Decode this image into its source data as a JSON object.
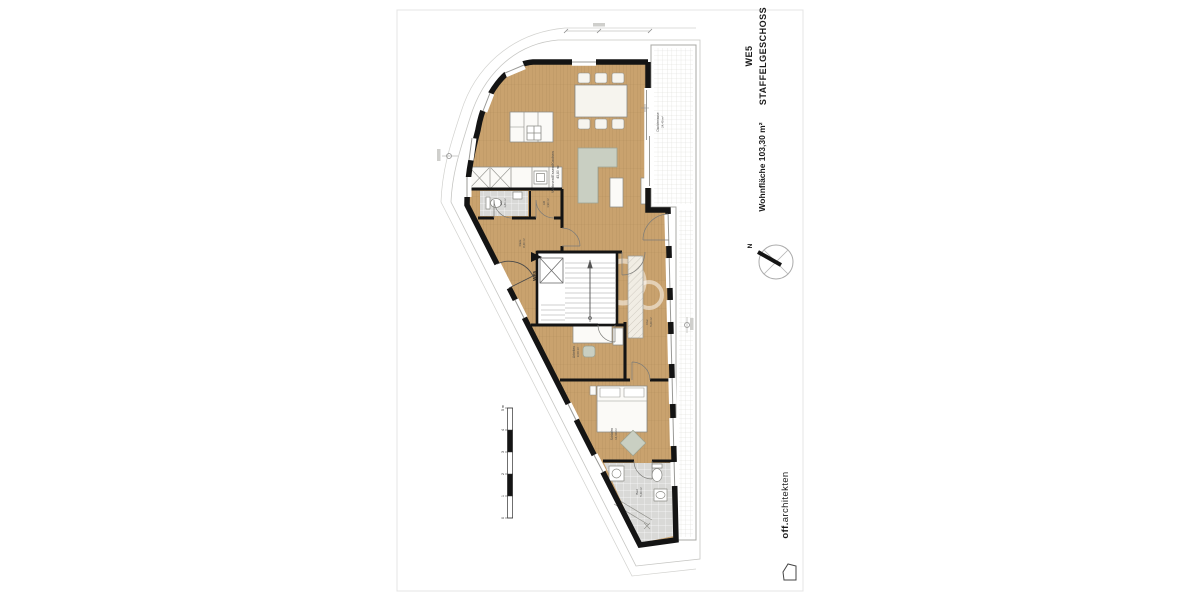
{
  "title_block": {
    "unit": "WE5",
    "floor": "STAFFELGESCHOSS",
    "area_label": "Wohnfläche 103,30 m²"
  },
  "compass": {
    "north_label": "N"
  },
  "logo": {
    "brand_bold": "off.",
    "brand_rest": "architekten"
  },
  "entrance_marker": {
    "label": "WE5"
  },
  "scale_bar": {
    "tick_labels": [
      "0",
      "1",
      "2",
      "3",
      "4",
      "5 m"
    ]
  },
  "rooms": {
    "living": {
      "name": "Wohnen/Essen/Kochen",
      "area": "43,80 m²"
    },
    "terrace": {
      "name": "Dachterrasse",
      "area": "24,40 m²"
    },
    "wc": {
      "name": "WC",
      "area": "1,80 m²"
    },
    "storage": {
      "name": "AR",
      "area": "1,90 m²"
    },
    "hall": {
      "name": "Diele",
      "area": "8,40 m²"
    },
    "corridor": {
      "name": "Flur",
      "area": "5,60 m²"
    },
    "office": {
      "name": "Arbeiten",
      "area": "9,60 m²"
    },
    "bedroom": {
      "name": "Schlafen",
      "area": "14,60 m²"
    },
    "bath": {
      "name": "Bad",
      "area": "5,40 m²"
    }
  },
  "icons": {
    "compass_needle": "north-arrow-icon",
    "logo_mark": "house-icon",
    "entrance_arrow": "entrance-arrow-icon"
  },
  "colors": {
    "wall": "#141414",
    "wood_floor": "#c9a26e",
    "tile_floor": "#d9d9d7",
    "furniture_fill": "#fbfaf7",
    "upholstery": "#c9cfc2",
    "thin_line": "#9b9b9b",
    "paper": "#ffffff"
  }
}
